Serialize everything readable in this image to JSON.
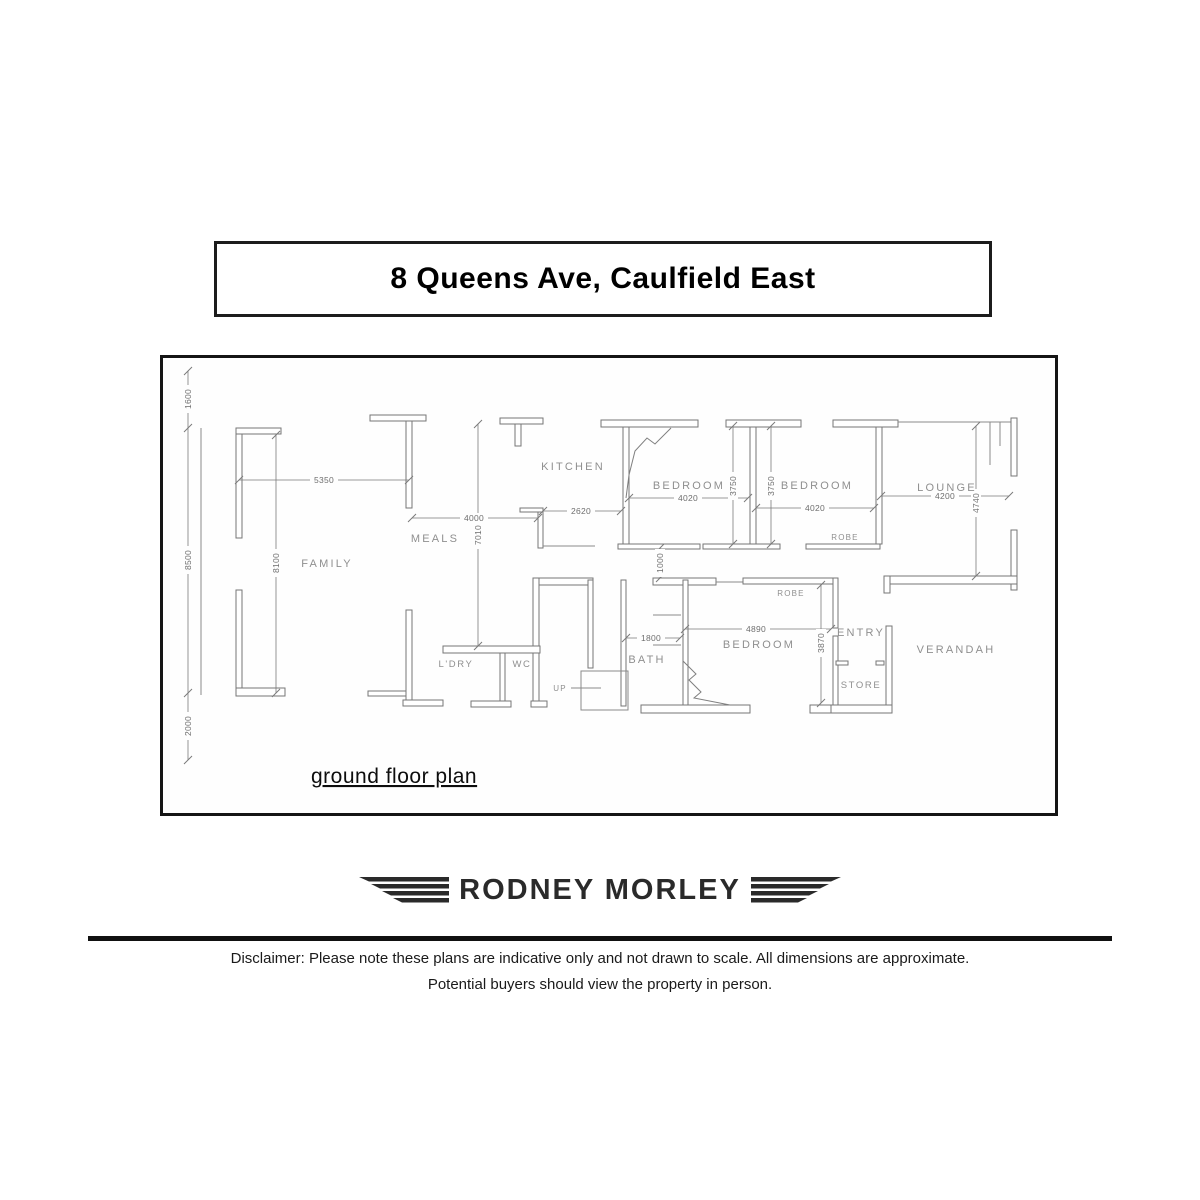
{
  "title": "8 Queens Ave, Caulfield East",
  "plan": {
    "caption": "ground floor plan",
    "rooms": [
      {
        "label": "KITCHEN"
      },
      {
        "label": "BEDROOM"
      },
      {
        "label": "BEDROOM"
      },
      {
        "label": "LOUNGE"
      },
      {
        "label": "MEALS"
      },
      {
        "label": "FAMILY"
      },
      {
        "label": "ROBE"
      },
      {
        "label": "ROBE"
      },
      {
        "label": "L'DRY"
      },
      {
        "label": "WC"
      },
      {
        "label": "BATH"
      },
      {
        "label": "BEDROOM"
      },
      {
        "label": "ENTRY"
      },
      {
        "label": "STORE"
      },
      {
        "label": "VERANDAH"
      },
      {
        "label": "UP"
      }
    ],
    "dimensions": [
      {
        "value": "1600"
      },
      {
        "value": "8500"
      },
      {
        "value": "2000"
      },
      {
        "value": "8100"
      },
      {
        "value": "5350"
      },
      {
        "value": "4000"
      },
      {
        "value": "7010"
      },
      {
        "value": "2620"
      },
      {
        "value": "4020"
      },
      {
        "value": "3750"
      },
      {
        "value": "3750"
      },
      {
        "value": "4020"
      },
      {
        "value": "4200"
      },
      {
        "value": "4740"
      },
      {
        "value": "1000"
      },
      {
        "value": "1800"
      },
      {
        "value": "4890"
      },
      {
        "value": "3870"
      }
    ]
  },
  "logo": {
    "text": "RODNEY MORLEY"
  },
  "footer": {
    "disclaimer_line1": "Disclaimer: Please note these plans are indicative only and not drawn to scale. All dimensions are approximate.",
    "disclaimer_line2": "Potential buyers should view the property in person."
  }
}
